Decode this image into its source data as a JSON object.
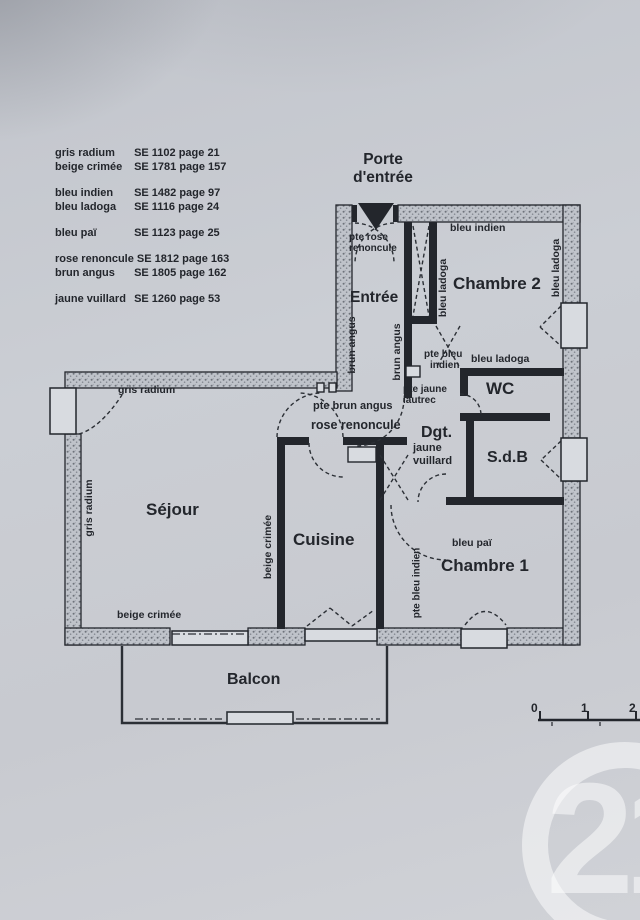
{
  "colors": {
    "paper": "#c9ccd3",
    "ink": "#23262c",
    "watermark": "rgba(255,255,255,0.5)"
  },
  "legend": {
    "groups": [
      {
        "items": [
          {
            "name": "gris radium",
            "ref": "SE 1102 page 21"
          },
          {
            "name": "beige crimée",
            "ref": "SE 1781 page 157"
          }
        ]
      },
      {
        "items": [
          {
            "name": "bleu indien",
            "ref": "SE 1482 page 97"
          },
          {
            "name": "bleu ladoga",
            "ref": "SE 1116 page 24"
          }
        ]
      },
      {
        "items": [
          {
            "name": "bleu paï",
            "ref": "SE 1123 page 25"
          }
        ]
      },
      {
        "items": [
          {
            "name": "rose renoncule",
            "ref": "SE 1812 page 163"
          },
          {
            "name": "brun angus",
            "ref": "SE 1805 page 162"
          }
        ]
      },
      {
        "items": [
          {
            "name": "jaune vuillard",
            "ref": "SE 1260 page 53"
          }
        ]
      }
    ]
  },
  "entrance": {
    "line1": "Porte",
    "line2": "d'entrée"
  },
  "rooms": {
    "entree": "Entrée",
    "sejour": "Séjour",
    "cuisine": "Cuisine",
    "chambre1": "Chambre 1",
    "chambre2": "Chambre 2",
    "wc": "WC",
    "sdb": "S.d.B",
    "dgt": "Dgt.",
    "balcon": "Balcon"
  },
  "paint_labels": {
    "gris_radium_top": "gris radium",
    "gris_radium_side": "gris radium",
    "beige_crimee_bottom": "beige crimée",
    "beige_crimee_side": "beige crimée",
    "bleu_indien": "bleu indien",
    "bleu_ladoga_left": "bleu ladoga",
    "bleu_ladoga_right": "bleu ladoga",
    "bleu_ladoga_wc": "bleu ladoga",
    "bleu_pai": "bleu paï",
    "brun_angus_left": "brun angus",
    "brun_angus_right": "brun angus",
    "jaune_vuillard_line1": "jaune",
    "jaune_vuillard_line2": "vuillard"
  },
  "door_labels": {
    "pte_rose_renoncule_line1": "pte rose",
    "pte_rose_renoncule_line2": "renoncule",
    "pte_bleu_indien_line1": "pte bleu",
    "pte_bleu_indien_line2": "indien",
    "pte_jaune_lautrec_line1": "pte jaune",
    "pte_jaune_lautrec_line2": "lautrec",
    "pte_brun_angus": "pte brun angus",
    "rose_renoncule": "rose renoncule",
    "pte_bleu_indien_side": "pte bleu indien"
  },
  "scale_bar": {
    "ticks": [
      "0",
      "1",
      "2"
    ]
  },
  "watermark": {
    "text": "21"
  }
}
